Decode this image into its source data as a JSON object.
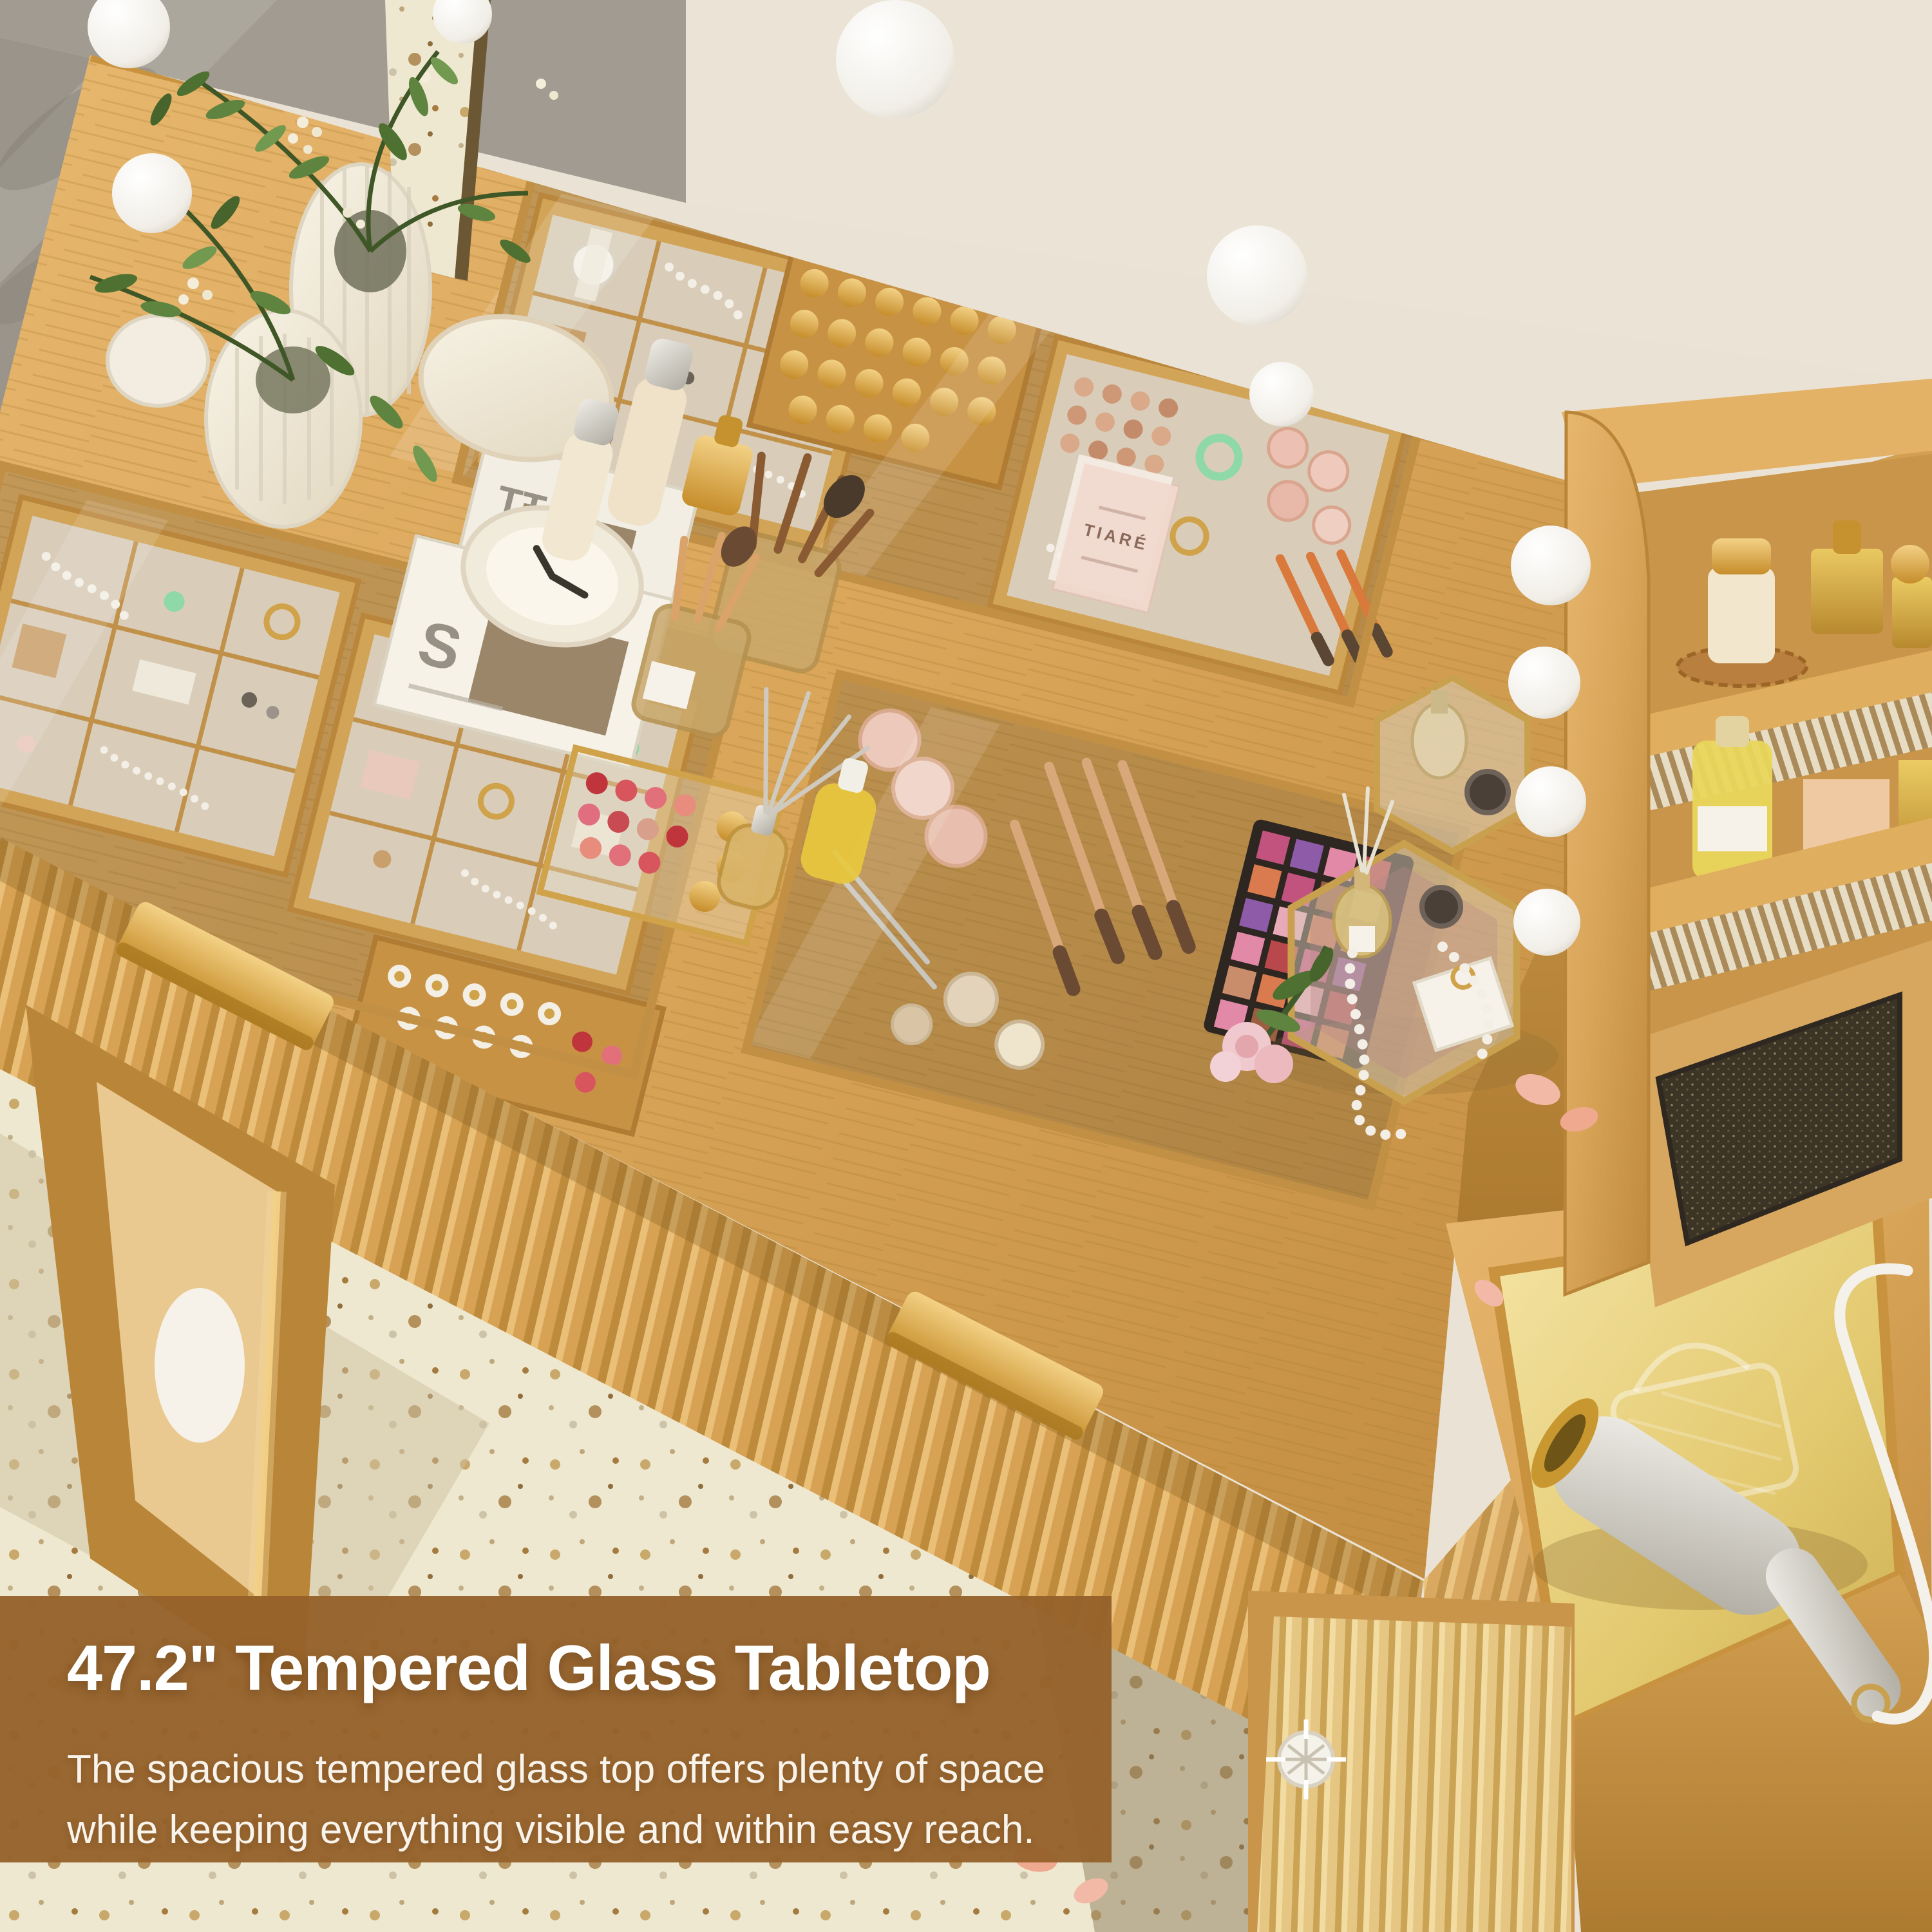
{
  "overlay": {
    "heading": "47.2\" Tempered Glass Tabletop",
    "body_line1": "The spacious tempered glass top offers plenty of space",
    "body_line2": "while keeping everything visible and within easy reach."
  },
  "labels": {
    "sachet_brand": "TIARÉ",
    "book_top_letters": "TT",
    "book_bottom_letter": "S"
  },
  "colors": {
    "overlay_bg": "#96622B",
    "overlay_heading_text": "#FFFFFF",
    "overlay_body_text": "#F8F3EB",
    "wood_light": "#E2B269",
    "wood_mid": "#D4A054",
    "wood_dark": "#B98538",
    "gold_hardware": "#D89E3C",
    "wall_gray": "#A19B91",
    "wall_cream": "#EAE3D5",
    "floor_terrazzo": "#EFE8D1",
    "glass_tint": "#8C6F46",
    "side_glass_gold": "#E9D089",
    "leaf_green": "#5E8440",
    "felt_lining": "#D9CDB9",
    "mesh_rattan": "#3C3526",
    "bulb_white": "#F7F5F0"
  }
}
